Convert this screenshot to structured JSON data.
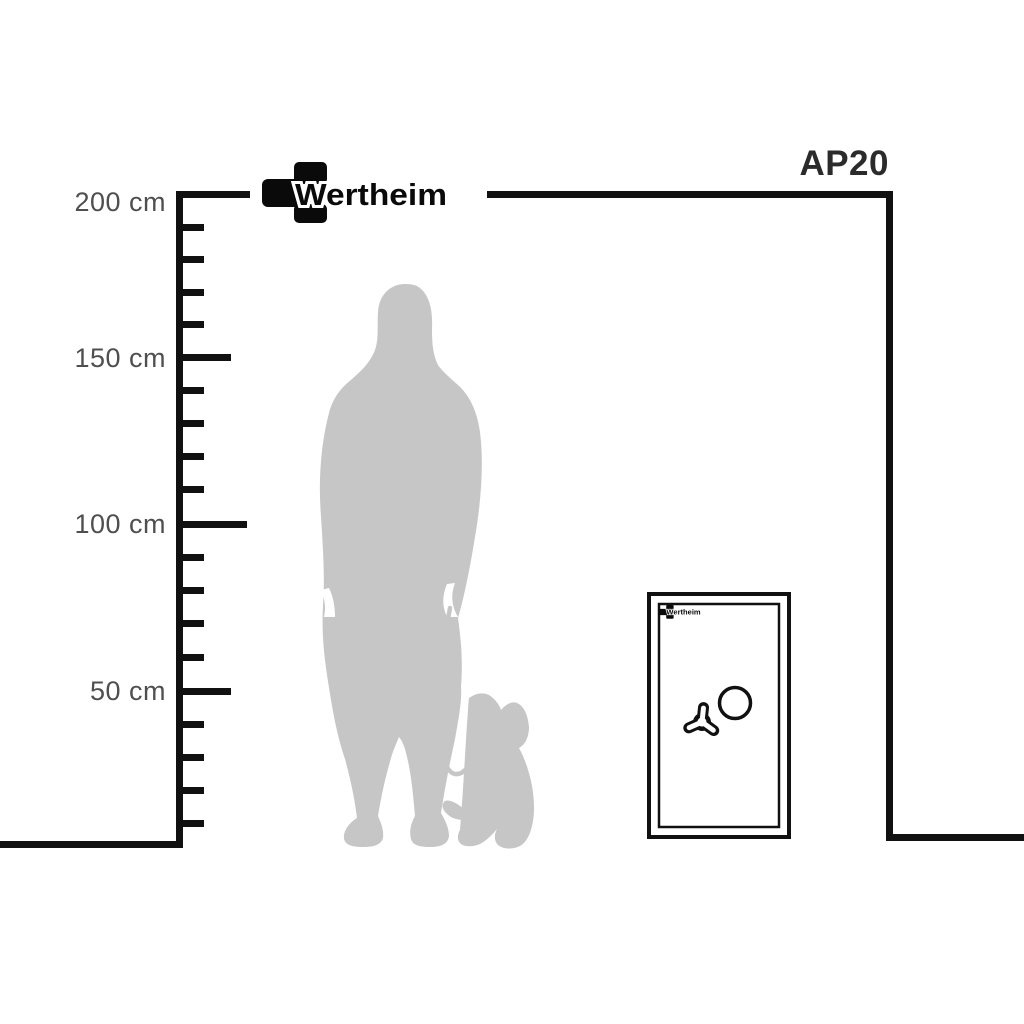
{
  "brand": {
    "name": "Wertheim"
  },
  "model": {
    "label": "AP20"
  },
  "ruler": {
    "unit": "cm",
    "labels": [
      "200 cm",
      "150 cm",
      "100 cm",
      "50 cm"
    ],
    "major_tick_values_cm": [
      200,
      150,
      100,
      50
    ],
    "minor_tick_step_cm": 10,
    "range_cm": [
      0,
      200
    ]
  },
  "figures": {
    "person": "standing-woman-silhouette",
    "dog": "sitting-dog-on-leash-silhouette",
    "safe": "safe-front-view"
  },
  "icons": {
    "logo": "wertheim-cross-logo-icon",
    "safe_handle": "tri-spoke-handle-icon",
    "safe_dial": "round-dial-icon"
  },
  "colors": {
    "background": "#ffffff",
    "line": "#111111",
    "silhouette": "#c6c6c6",
    "ruler_label": "#4f4f4f",
    "model_label": "#2b2b2b",
    "logo": "#0a0a0a"
  }
}
